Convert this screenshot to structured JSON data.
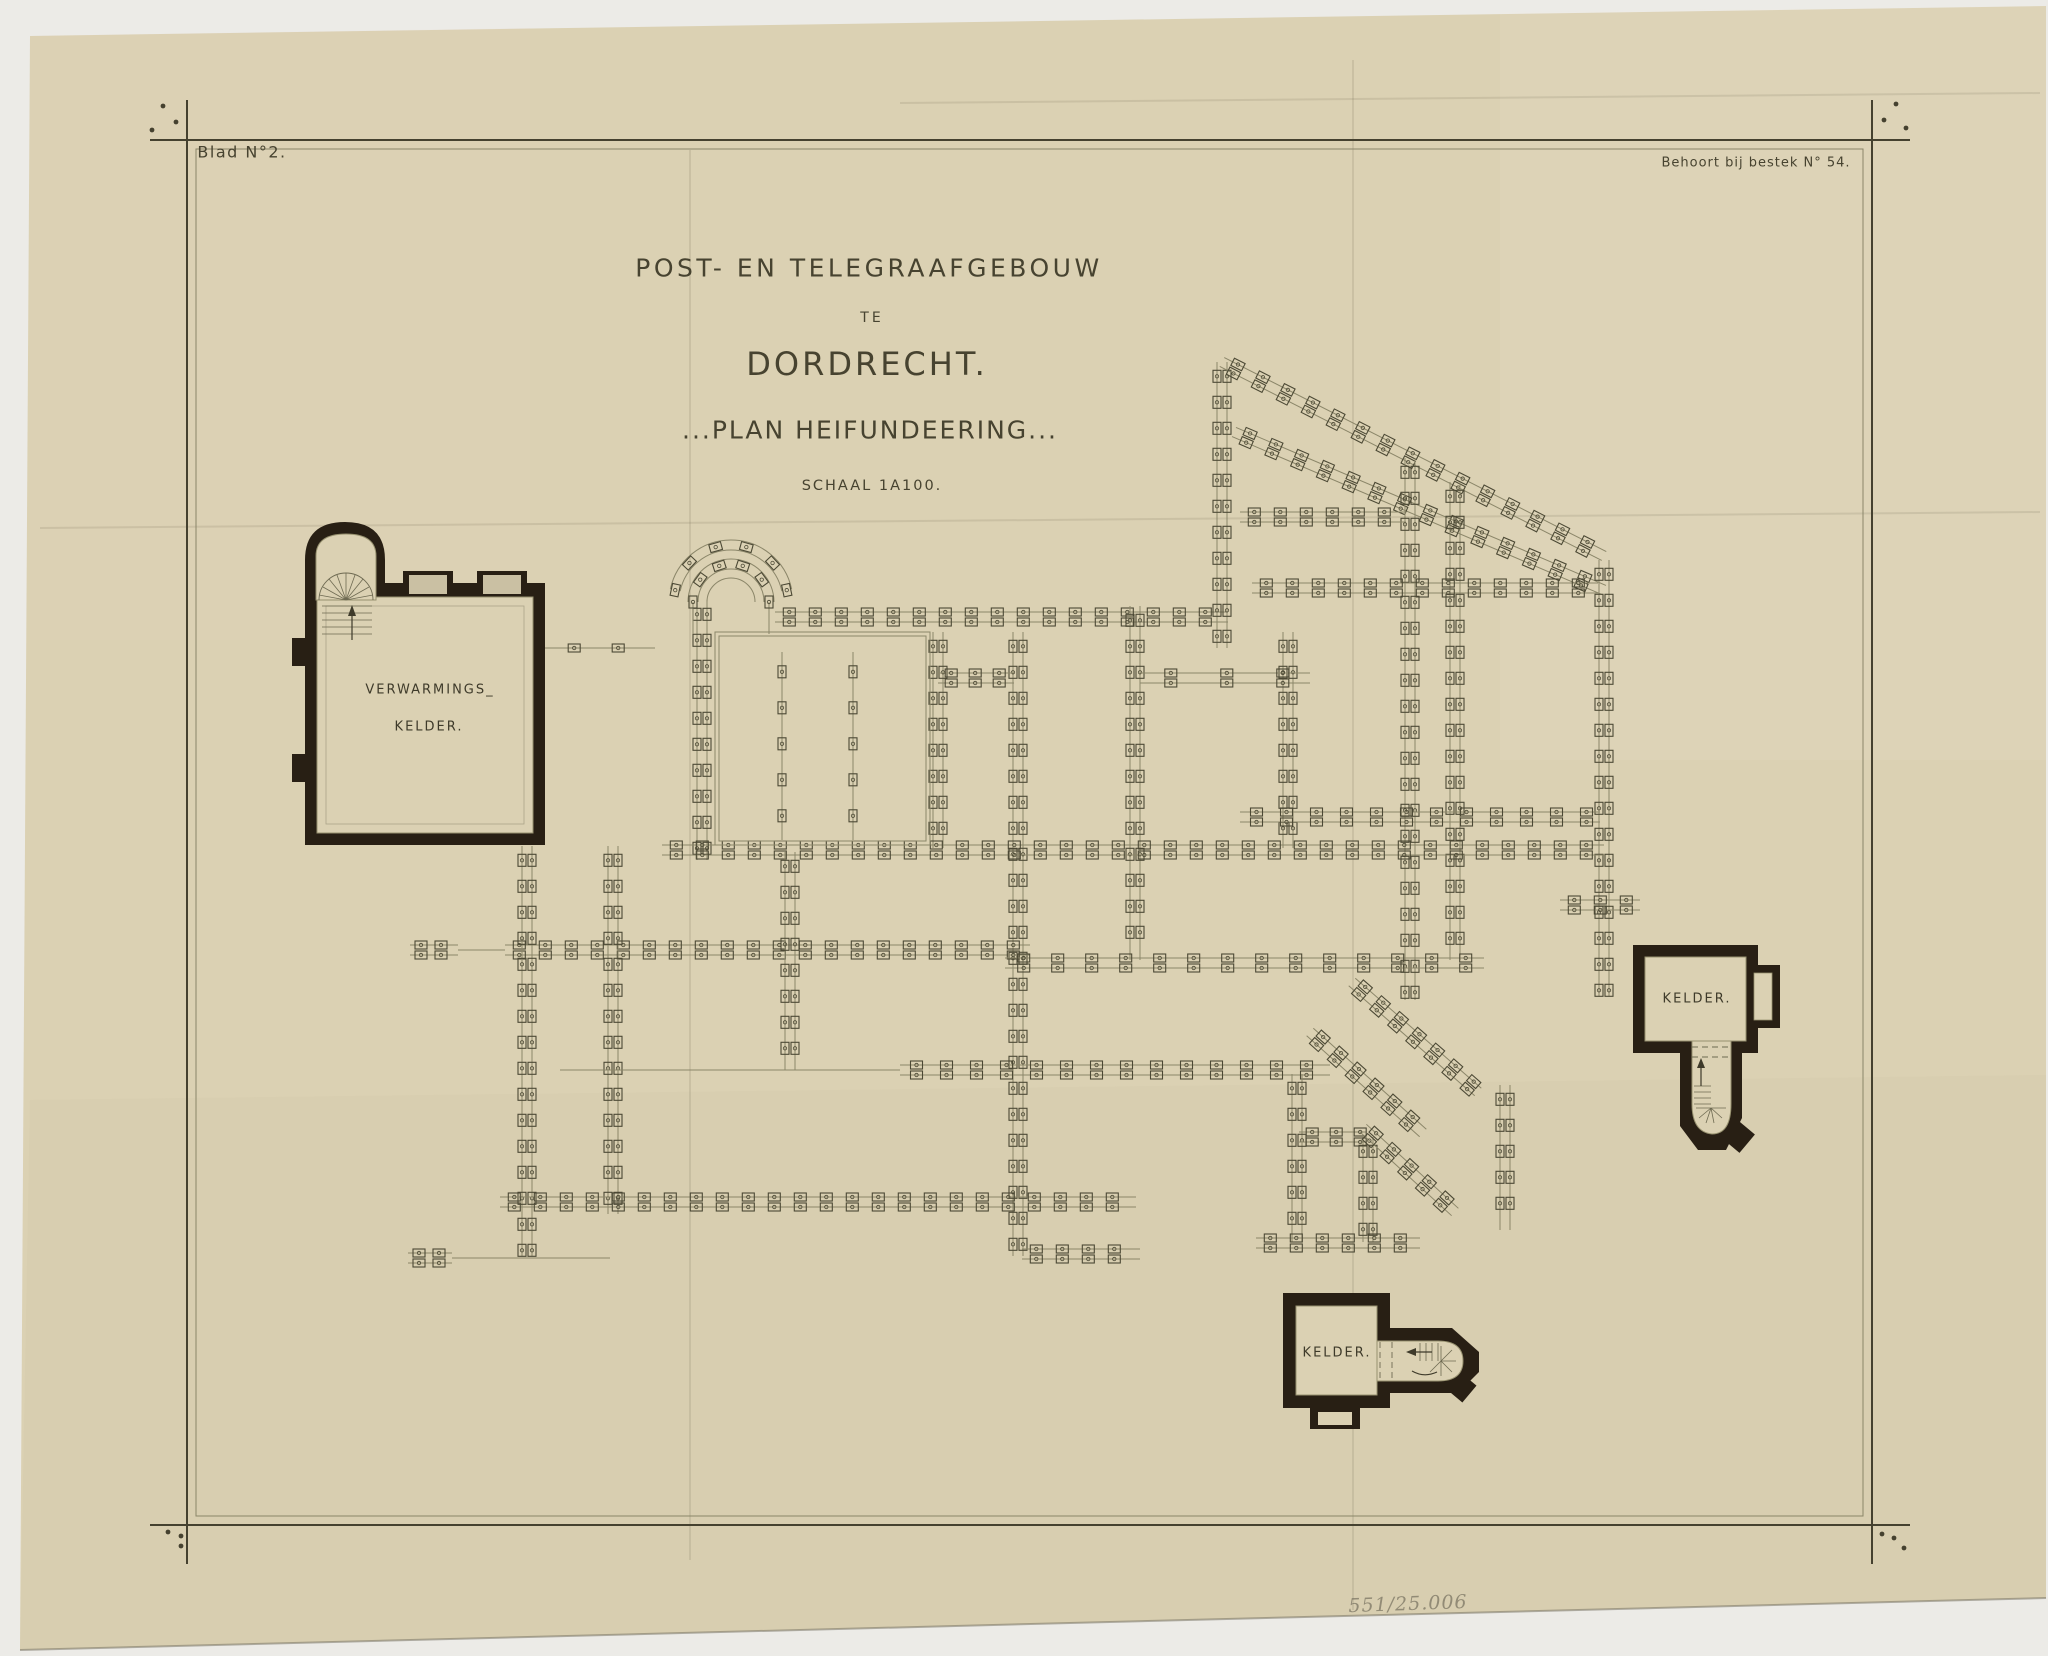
{
  "document": {
    "sheet_label": "Blad N°2.",
    "spec_label": "Behoort bij bestek N° 54.",
    "title_line1": "POST- EN TELEGRAAFGEBOUW",
    "title_line2": "TE",
    "title_line3": "DORDRECHT.",
    "title_line4": "...PLAN HEIFUNDEERING...",
    "title_line5": "SCHAAL 1A100.",
    "pencil_note": "551/25.006"
  },
  "labels": {
    "verwarmings_line1": "VERWARMINGS_",
    "verwarmings_line2": "KELDER.",
    "kelder_right": "KELDER.",
    "kelder_bottom": "KELDER."
  },
  "colors": {
    "backdrop": "#ecebe7",
    "paper": "#dbd1b3",
    "ink": "#4c4935",
    "ink_light": "#8b8669",
    "wall": "#281f14"
  },
  "plan": {
    "ink": "#4c4935",
    "ink_light": "#8b8669",
    "strips": [
      {
        "x1": 702,
        "y1": 600,
        "x2": 702,
        "y2": 860,
        "step": 26
      },
      {
        "x1": 775,
        "y1": 617,
        "x2": 1228,
        "y2": 617,
        "step": 26
      },
      {
        "x1": 938,
        "y1": 632,
        "x2": 938,
        "y2": 848,
        "step": 26
      },
      {
        "x1": 1018,
        "y1": 632,
        "x2": 1018,
        "y2": 1256,
        "step": 26
      },
      {
        "x1": 1135,
        "y1": 606,
        "x2": 1135,
        "y2": 960,
        "step": 26
      },
      {
        "x1": 1288,
        "y1": 632,
        "x2": 1288,
        "y2": 848,
        "step": 26
      },
      {
        "x1": 1222,
        "y1": 362,
        "x2": 1222,
        "y2": 648,
        "step": 26
      },
      {
        "x1": 1222,
        "y1": 362,
        "x2": 1604,
        "y2": 556,
        "step": 28
      },
      {
        "x1": 1234,
        "y1": 432,
        "x2": 1604,
        "y2": 590,
        "step": 28
      },
      {
        "x1": 1410,
        "y1": 458,
        "x2": 1410,
        "y2": 1000,
        "step": 26
      },
      {
        "x1": 1455,
        "y1": 482,
        "x2": 1455,
        "y2": 960,
        "step": 26
      },
      {
        "x1": 1604,
        "y1": 560,
        "x2": 1604,
        "y2": 996,
        "step": 26
      },
      {
        "x1": 1240,
        "y1": 517,
        "x2": 1406,
        "y2": 517,
        "step": 26
      },
      {
        "x1": 1252,
        "y1": 588,
        "x2": 1598,
        "y2": 588,
        "step": 26
      },
      {
        "x1": 662,
        "y1": 850,
        "x2": 1604,
        "y2": 850,
        "step": 26
      },
      {
        "x1": 1240,
        "y1": 817,
        "x2": 1600,
        "y2": 817,
        "step": 30
      },
      {
        "x1": 505,
        "y1": 950,
        "x2": 1030,
        "y2": 950,
        "step": 26
      },
      {
        "x1": 410,
        "y1": 950,
        "x2": 458,
        "y2": 950,
        "step": 20
      },
      {
        "x1": 527,
        "y1": 846,
        "x2": 527,
        "y2": 1256,
        "step": 26
      },
      {
        "x1": 613,
        "y1": 846,
        "x2": 613,
        "y2": 1214,
        "step": 26
      },
      {
        "x1": 790,
        "y1": 852,
        "x2": 790,
        "y2": 1070,
        "step": 26
      },
      {
        "x1": 900,
        "y1": 1070,
        "x2": 1330,
        "y2": 1070,
        "step": 30
      },
      {
        "x1": 500,
        "y1": 1202,
        "x2": 1136,
        "y2": 1202,
        "step": 26
      },
      {
        "x1": 408,
        "y1": 1258,
        "x2": 452,
        "y2": 1258,
        "step": 20
      },
      {
        "x1": 1022,
        "y1": 1254,
        "x2": 1140,
        "y2": 1254,
        "step": 26
      },
      {
        "x1": 1005,
        "y1": 963,
        "x2": 1484,
        "y2": 963,
        "step": 34
      },
      {
        "x1": 1297,
        "y1": 1074,
        "x2": 1297,
        "y2": 1242,
        "step": 26
      },
      {
        "x1": 1368,
        "y1": 1137,
        "x2": 1368,
        "y2": 1242,
        "step": 26
      },
      {
        "x1": 1299,
        "y1": 1137,
        "x2": 1366,
        "y2": 1137,
        "step": 24
      },
      {
        "x1": 1256,
        "y1": 1243,
        "x2": 1420,
        "y2": 1243,
        "step": 26
      },
      {
        "x1": 1352,
        "y1": 982,
        "x2": 1478,
        "y2": 1092,
        "step": 24
      },
      {
        "x1": 1310,
        "y1": 1032,
        "x2": 1423,
        "y2": 1133,
        "step": 24
      },
      {
        "x1": 1363,
        "y1": 1128,
        "x2": 1455,
        "y2": 1212,
        "step": 24
      },
      {
        "x1": 1505,
        "y1": 1085,
        "x2": 1505,
        "y2": 1230,
        "step": 26
      },
      {
        "x1": 938,
        "y1": 678,
        "x2": 1014,
        "y2": 678,
        "step": 24
      },
      {
        "x1": 1560,
        "y1": 905,
        "x2": 1640,
        "y2": 905,
        "step": 26
      },
      {
        "x1": 462,
        "y1": 648,
        "x2": 655,
        "y2": 648,
        "step": 44,
        "rows": 1
      },
      {
        "x1": 462,
        "y1": 648,
        "x2": 438,
        "y2": 838,
        "step": 44,
        "rows": 1
      },
      {
        "x1": 1140,
        "y1": 678,
        "x2": 1310,
        "y2": 678,
        "step": 56
      },
      {
        "x1": 782,
        "y1": 652,
        "x2": 782,
        "y2": 840,
        "step": 36,
        "rows": 1
      },
      {
        "x1": 853,
        "y1": 652,
        "x2": 853,
        "y2": 840,
        "step": 36,
        "rows": 1
      }
    ],
    "lines": [
      {
        "x1": 560,
        "y1": 1070,
        "x2": 900,
        "y2": 1070
      },
      {
        "x1": 458,
        "y1": 950,
        "x2": 505,
        "y2": 950
      },
      {
        "x1": 452,
        "y1": 1258,
        "x2": 610,
        "y2": 1258
      },
      {
        "x1": 693,
        "y1": 602,
        "x2": 693,
        "y2": 634
      },
      {
        "x1": 769,
        "y1": 602,
        "x2": 769,
        "y2": 634
      }
    ],
    "rects": [
      {
        "x": 715,
        "y": 632,
        "w": 215,
        "h": 213
      },
      {
        "x": 719,
        "y": 636,
        "w": 207,
        "h": 205
      }
    ],
    "arcs": [
      {
        "cx": 731,
        "cy": 602,
        "r": 38,
        "a1": 180,
        "a2": 360,
        "step": 22
      },
      {
        "cx": 731,
        "cy": 602,
        "r": 57,
        "a1": 192,
        "a2": 348,
        "step": 26
      },
      {
        "cx": 731,
        "cy": 602,
        "r": 24,
        "a1": 180,
        "a2": 360,
        "step": 0,
        "single": true
      }
    ]
  }
}
